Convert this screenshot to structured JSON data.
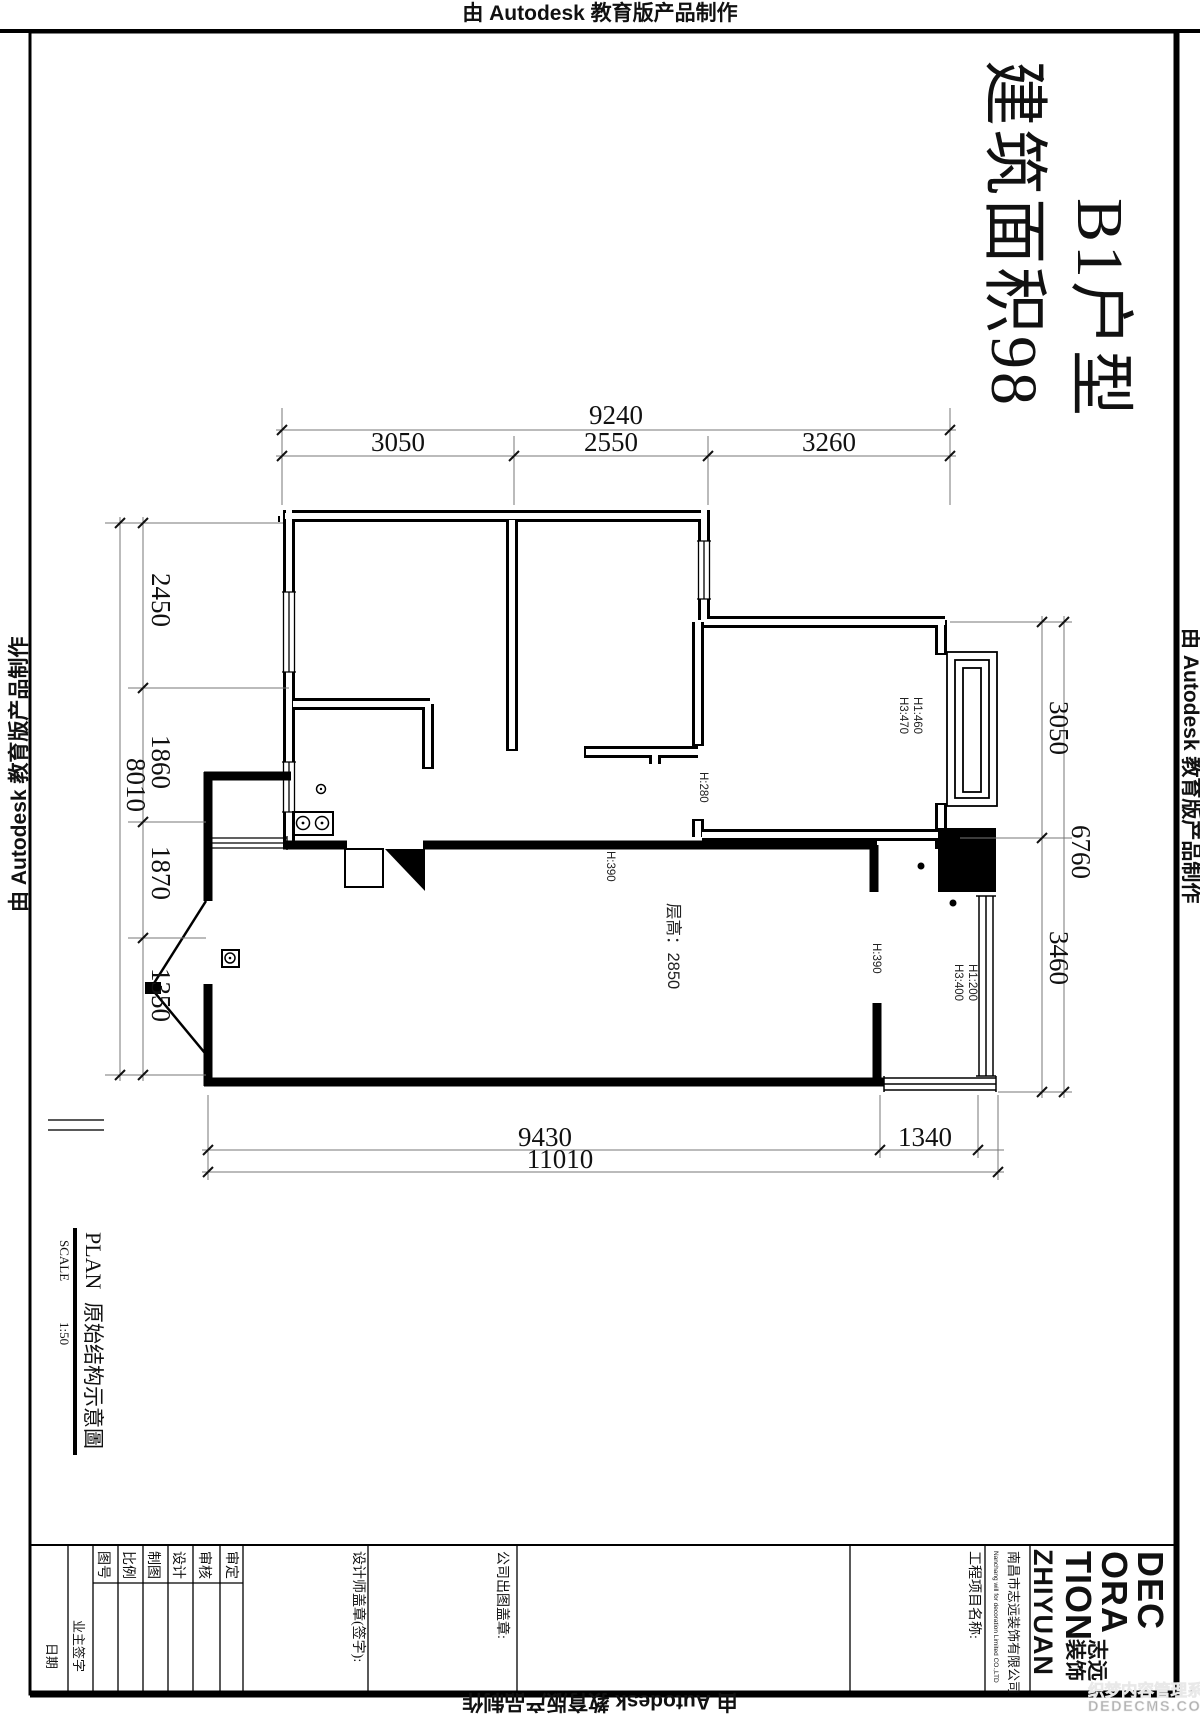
{
  "banner": {
    "autodesk": "由 Autodesk 教育版产品制作"
  },
  "sheet_title": {
    "type": "B1户型",
    "area": "建筑面积98"
  },
  "dims": {
    "top_overall": "9240",
    "top": [
      "3050",
      "2550",
      "3260"
    ],
    "left_overall": "8010",
    "left": [
      "2450",
      "1860",
      "1870",
      "1350"
    ],
    "right_overall": "6760",
    "right": [
      "3050",
      "3460"
    ],
    "bottom_overall": "11010",
    "bottom": [
      "9430",
      "1340"
    ]
  },
  "plan_labels": {
    "ceiling_height": "层高：2850",
    "h390_kitchen": "H:390",
    "h390_balcony": "H:390",
    "h280": "H:280",
    "h1_460": "H1:460",
    "h3_470": "H3:470",
    "h1_200": "H1:200",
    "h3_400": "H3:400"
  },
  "plan_caption": {
    "en": "PLAN",
    "zh": "原始结构示意圖",
    "scale_label": "SCALE",
    "scale_value": "1:50"
  },
  "titleblock": {
    "approve": "审定",
    "review": "审核",
    "design": "设计",
    "draft": "制图",
    "scale": "比例",
    "drawing_no": "图号",
    "owner_sign": "业主签字",
    "date": "日期",
    "designer_stamp": "设计师盖章(签字):",
    "company_stamp": "公司出图盖章:",
    "project_name": "工程项目名称:",
    "company_zh": "南昌市志远装饰有限公司",
    "company_en": "Nanchang will for decoration Limited CO.,LTD"
  },
  "logo": {
    "l1": "DEC",
    "l2": "ORA",
    "l3": "TION",
    "l4": "ZHIYUAN",
    "zh_1": "志远",
    "zh_2": "装饰"
  },
  "watermark": {
    "line1": "织梦内容管理系统",
    "line2": "DEDECMS.COM"
  }
}
